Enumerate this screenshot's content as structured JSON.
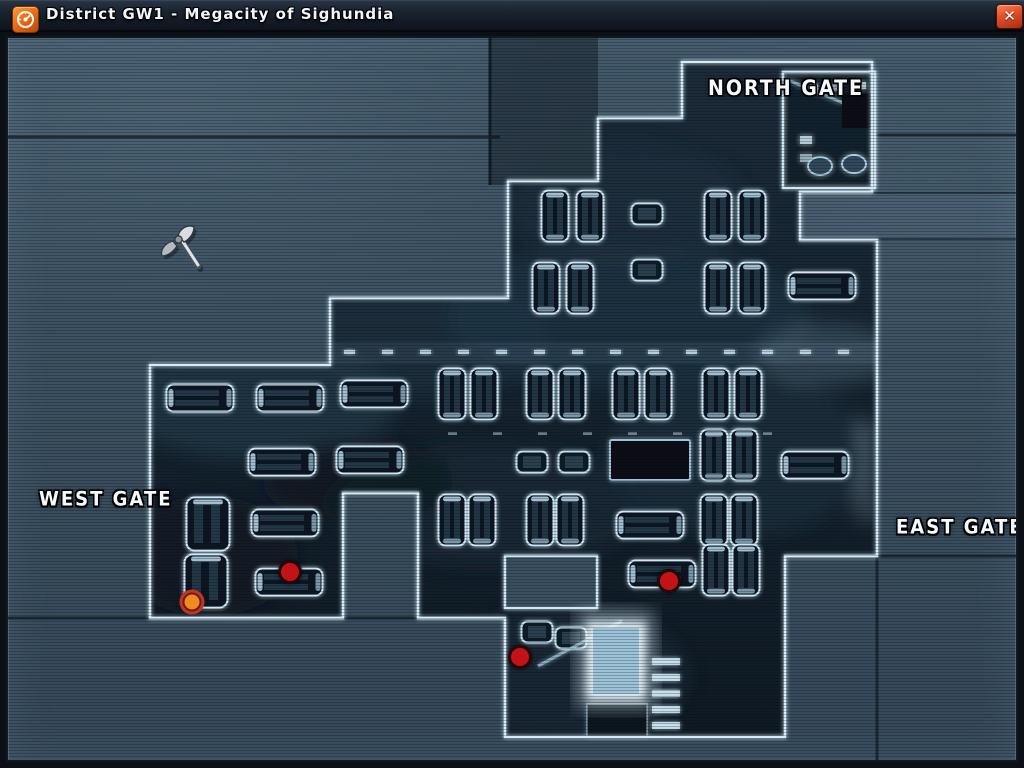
{
  "window": {
    "title": "District GW1 - Megacity of Sighundia"
  },
  "titlebar": {
    "icon": "district-gauge-icon",
    "close_label": "✕"
  },
  "map": {
    "gates": {
      "north": "NORTH GATE",
      "west": "WEST GATE",
      "east": "EAST GATE",
      "south": "SOUTH GATE"
    },
    "markers": [
      {
        "type": "selected",
        "x": 192,
        "y": 602
      },
      {
        "type": "enemy",
        "x": 290,
        "y": 572
      },
      {
        "type": "enemy",
        "x": 669,
        "y": 581
      },
      {
        "type": "enemy",
        "x": 520,
        "y": 657
      }
    ],
    "colors": {
      "marker_red": "#c21318",
      "marker_selected_center": "#ef8a1c",
      "outline_glow": "#d6ecf8",
      "background": "#3e5363",
      "compound": "#15232f",
      "accent_orange": "#e96c1e"
    }
  },
  "cursor": {
    "name": "battle-axe-cursor",
    "x": 160,
    "y": 224
  }
}
